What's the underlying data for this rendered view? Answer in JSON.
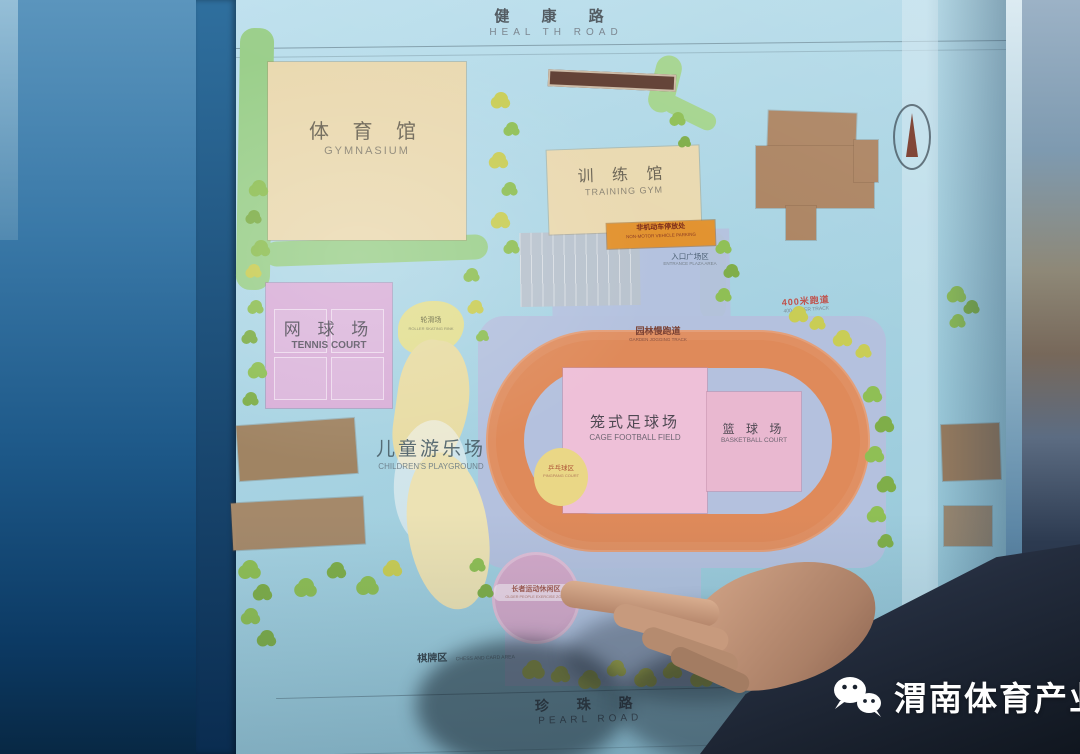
{
  "watermark": {
    "name": "渭南体育产业",
    "icon": "wechat"
  },
  "colors": {
    "board": "#a9d3e2",
    "frame_blue": "#2f6f9e",
    "track_orange": "#df8a5a",
    "court_pink": "#eec0d8",
    "building_beige": "#ead9b0",
    "building_brown": "#ac8462",
    "plaza_blue": "#b4c1de",
    "green_path": "#9bcf8b",
    "tree_yellow": "#c9cd55",
    "tag_orange": "#e2922e",
    "senior_pink": "#d3a9c9"
  },
  "map": {
    "road_top": {
      "zh": "健 康 路",
      "en": "HEAL TH ROAD"
    },
    "road_bottom": {
      "zh": "珍 珠 路",
      "en": "PEARL ROAD"
    },
    "gymnasium": {
      "zh": "体 育 馆",
      "en": "GYMNASIUM"
    },
    "training_gym": {
      "zh": "训 练 馆",
      "en": "TRAINING GYM"
    },
    "tennis_court": {
      "zh": "网 球 场",
      "en": "TENNIS COURT"
    },
    "cage_football": {
      "zh": "笼式足球场",
      "en": "CAGE FOOTBALL FIELD"
    },
    "basketball": {
      "zh": "篮 球 场",
      "en": "BASKETBALL COURT"
    },
    "children_playground": {
      "zh": "儿童游乐场",
      "en": "CHILDREN'S PLAYGROUND"
    },
    "roller_skating": {
      "zh": "轮滑场",
      "en": "ROLLER SKATING RINK"
    },
    "pingpong": {
      "zh": "乒乓球区",
      "en": "PINGPANG COURT"
    },
    "senior_zone": {
      "zh": "长者运动休闲区",
      "en": "OLDER PEOPLE EXERCISE ZONE"
    },
    "chess_area": {
      "zh": "棋牌区",
      "en": "CHESS AND CARD AREA"
    },
    "bike_parking": {
      "zh": "非机动车停放处",
      "en": "NON-MOTOR VEHICLE PARKING"
    },
    "jogging_track": {
      "zh": "园林慢跑道",
      "en": "GARDEN JOGGING TRACK"
    },
    "track_400": {
      "zh": "400米跑道",
      "en": "400-METER TRACK"
    },
    "entrance_plaza": {
      "zh": "入口广场区",
      "en": "ENTRANCE PLAZA AREA"
    }
  }
}
